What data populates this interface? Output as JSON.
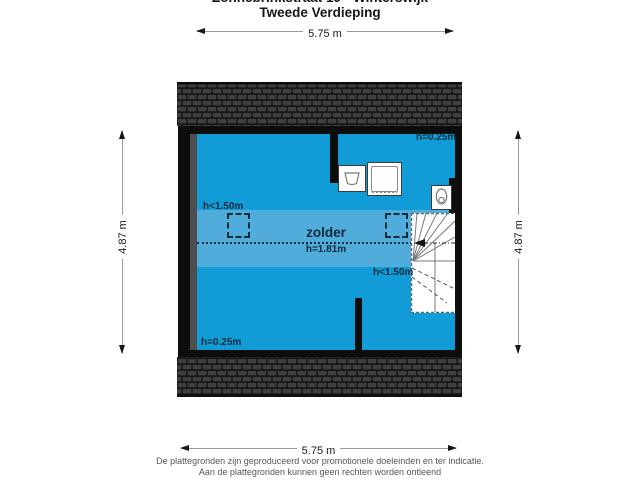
{
  "header": {
    "address": "Zonnebrinkstraat 19 - Winterswijk",
    "floor": "Tweede Verdieping"
  },
  "dims": {
    "top": "5.75 m",
    "bottom": "5.75 m",
    "left": "4.87 m",
    "right": "4.87 m"
  },
  "plan": {
    "room_label": "zolder",
    "ridge_label": "h=1.81m",
    "h_top_right": "h=0.25m",
    "h_bottom_left": "h=0.25m",
    "h_band_left": "h<1.50m",
    "h_band_right": "h<1.50m",
    "fixtures": [
      "sink",
      "washing-machine",
      "toilet",
      "winder-stairs",
      "chimney"
    ],
    "colors": {
      "floor_main": "#119CD8",
      "floor_low_band": "#4FACDB",
      "wall": "#0d0d0d",
      "roof_tile": "#3f3f3f",
      "roof_background": "#181818",
      "plan_label": "#0d2b3a"
    }
  },
  "footer": {
    "line1": "De plattegronden zijn geproduceerd voor promotionele doeleinden en ter indicatie.",
    "line2": "Aan de plattegronden kunnen geen rechten worden ontleend"
  }
}
